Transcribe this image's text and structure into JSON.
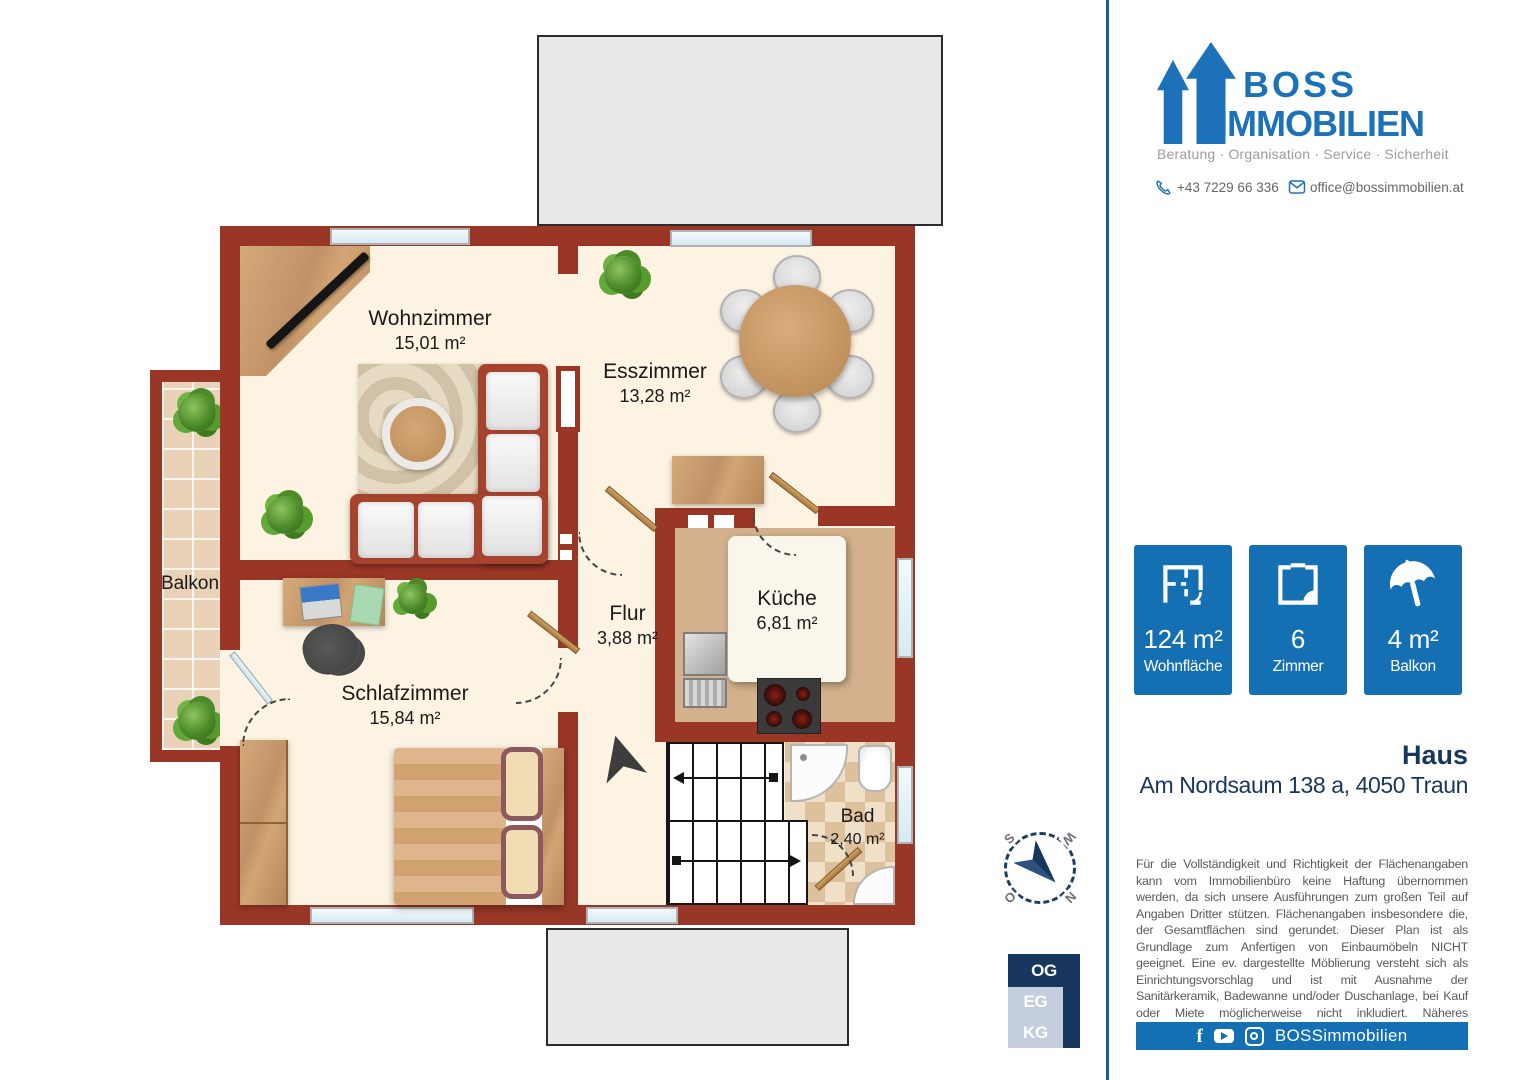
{
  "brand": {
    "line1": "BOSS",
    "line2": "IMMOBILIEN",
    "tagline": "Beratung · Organisation · Service · Sicherheit",
    "phone": "+43 7229 66 336",
    "email": "office@bossimmobilien.at"
  },
  "stats": [
    {
      "value": "124 m²",
      "label": "Wohnfläche",
      "icon": "floorplan-icon"
    },
    {
      "value": "6",
      "label": "Zimmer",
      "icon": "room-icon"
    },
    {
      "value": "4 m²",
      "label": "Balkon",
      "icon": "umbrella-icon"
    }
  ],
  "property": {
    "title": "Haus",
    "address": "Am Nordsaum 138 a, 4050 Traun"
  },
  "disclaimer": "Für die Vollständigkeit und Richtigkeit der Flächenangaben kann vom Immobilienbüro keine Haftung übernommen werden, da sich unsere Ausführungen zum großen Teil auf Angaben Dritter stützen. Flächenangaben insbesondere die, der Gesamtflächen sind gerundet. Dieser Plan ist als Grundlage zum Anfertigen von Einbaumöbeln NICHT geeignet. Eine ev. dargestellte Möblierung versteht sich als Einrichtungsvorschlag und ist mit Ausnahme der Sanitärkeramik, Badewanne und/oder Duschanlage, bei Kauf oder Miete möglicherweise nicht inkludiert. Näheres entnehmen Sie bitte aus dem Inserat.",
  "footer": {
    "handle": "BOSSimmobilien"
  },
  "floor_selector": {
    "active": "OG",
    "options": [
      {
        "label": "OG"
      },
      {
        "label": "EG"
      },
      {
        "label": "KG"
      }
    ]
  },
  "compass": {
    "n": "N",
    "e": "O",
    "s": "S",
    "w": "W"
  },
  "plan": {
    "rooms": [
      {
        "name": "Wohnzimmer",
        "area": "15,01 m²"
      },
      {
        "name": "Esszimmer",
        "area": "13,28 m²"
      },
      {
        "name": "Flur",
        "area": "3,88 m²"
      },
      {
        "name": "Küche",
        "area": "6,81 m²"
      },
      {
        "name": "Schlafzimmer",
        "area": "15,84 m²"
      },
      {
        "name": "Bad",
        "area": "2,40 m²"
      },
      {
        "name": "Balkon",
        "area": ""
      }
    ]
  },
  "colors": {
    "brand_blue": "#1d71b8",
    "badge_blue": "#1470b2",
    "navy": "#17365d",
    "wall_red": "#993626"
  }
}
